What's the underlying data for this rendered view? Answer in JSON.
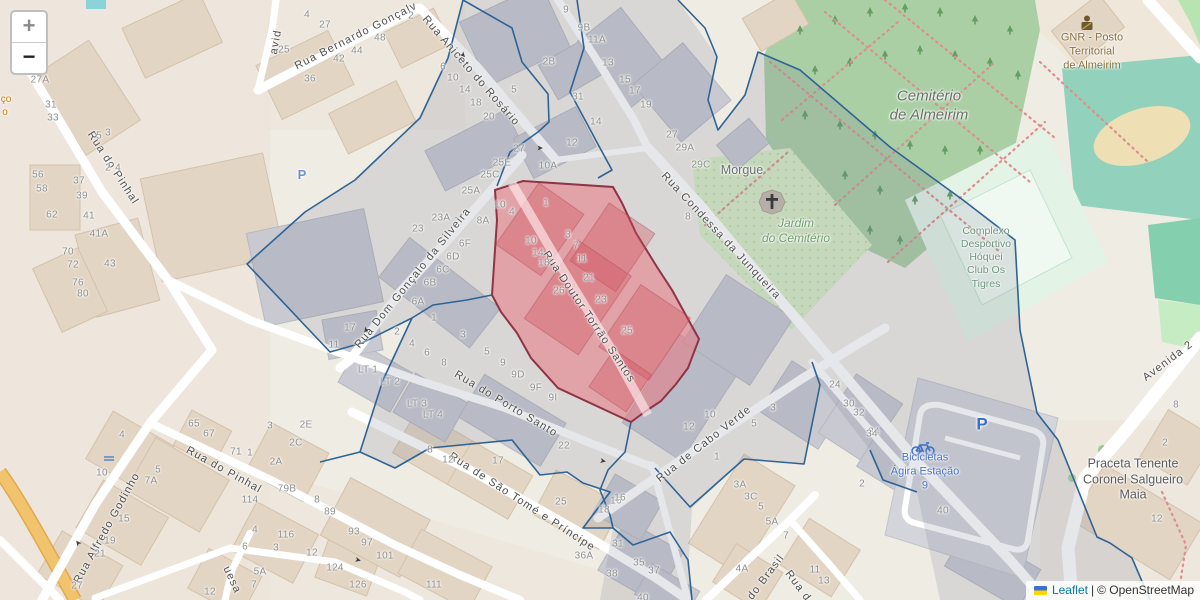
{
  "controls": {
    "zoom_in": "+",
    "zoom_out": "−"
  },
  "attribution": {
    "leaflet": "Leaflet",
    "separator": " | ",
    "osm": "© OpenStreetMap"
  },
  "colors": {
    "parcel_fill": "#e87f8a",
    "parcel_border": "#8f3346",
    "boundary_blue": "#2f6395",
    "cemetery_green": "#abcfa5",
    "jardim_green": "#d9edc6",
    "pitch_teal": "#92d1bc",
    "street_white": "#ffffff",
    "leaflet_link_blue": "#0078a8",
    "parking_blue": "#3a6cc8"
  },
  "streets": [
    [
      "Rua do Pinhal",
      113,
      168,
      57
    ],
    [
      "Rua do Pinhal",
      224,
      470,
      29
    ],
    [
      "Rua Alfredo Godinho",
      107,
      528,
      -61
    ],
    [
      "Rua Bernardo Gonçalv",
      356,
      36,
      -27
    ],
    [
      "avid",
      276,
      42,
      -80
    ],
    [
      "Rua Aniceto do Rosário",
      471,
      71,
      49
    ],
    [
      "Rua Dom Gonçalo da Silveira",
      413,
      278,
      -51
    ],
    [
      "Rua Doutor Torrão Santos",
      589,
      317,
      56
    ],
    [
      "Rua Condessa da Junqueira",
      721,
      236,
      47
    ],
    [
      "Rua do Porto Santo",
      506,
      404,
      31
    ],
    [
      "Rua de Cabo Verde",
      704,
      444,
      -38
    ],
    [
      "Rua de São Tomé e Príncipe",
      522,
      502,
      33
    ],
    [
      "do Brasil",
      766,
      577,
      -53
    ],
    [
      "Rua d",
      798,
      586,
      53
    ],
    [
      "Avenida 2",
      1168,
      361,
      -37
    ],
    [
      "uesa",
      232,
      580,
      65
    ]
  ],
  "pois": [
    {
      "lines": [
        "Morgue"
      ],
      "x": 742,
      "y": 171,
      "color": "#6d6d6d",
      "size": 12.5,
      "italic": false
    },
    {
      "lines": [
        "Cemitério",
        "de Almeirim"
      ],
      "x": 929,
      "y": 106,
      "color": "#687068",
      "size": 15,
      "italic": true
    },
    {
      "lines": [
        "Jardim",
        "do Cemitério"
      ],
      "x": 796,
      "y": 231,
      "color": "#72a072",
      "size": 12,
      "italic": true
    },
    {
      "lines": [
        "Complexo",
        "Desportivo",
        "Hóquei",
        "Club Os",
        "Tigres"
      ],
      "x": 986,
      "y": 258,
      "color": "#6e957e",
      "size": 10.5,
      "italic": false
    },
    {
      "lines": [
        "GNR - Posto",
        "Territorial",
        "de Almeirim"
      ],
      "x": 1092,
      "y": 52,
      "color": "#8a7240",
      "size": 11,
      "italic": false
    },
    {
      "lines": [
        "Bicicletas",
        "Ágira Estação",
        "9"
      ],
      "x": 925,
      "y": 472,
      "color": "#4a72c8",
      "size": 11,
      "italic": false
    },
    {
      "lines": [
        "Praceta Tenente",
        "Coronel Salgueiro",
        "Maia"
      ],
      "x": 1133,
      "y": 480,
      "color": "#5c5c5c",
      "size": 12.5,
      "italic": false
    },
    {
      "lines": [
        "ço"
      ],
      "x": 6,
      "y": 100,
      "color": "#d07b00",
      "size": 10,
      "italic": false
    },
    {
      "lines": [
        "o"
      ],
      "x": 5,
      "y": 113,
      "color": "#d07b00",
      "size": 10,
      "italic": false
    }
  ],
  "parking_labels": [
    {
      "t": "P",
      "x": 982,
      "y": 424,
      "size": 17,
      "color": "#3a6cc8"
    },
    {
      "t": "P",
      "x": 302,
      "y": 175,
      "size": 13,
      "color": "#6d92d4"
    }
  ],
  "arrows": [
    [
      463,
      55,
      47
    ],
    [
      540,
      148,
      0
    ],
    [
      366,
      330,
      125
    ],
    [
      78,
      543,
      233
    ],
    [
      358,
      560,
      15
    ],
    [
      603,
      461,
      10
    ]
  ],
  "house_numbers": [
    [
      "27A",
      40,
      80
    ],
    [
      "31",
      51,
      105
    ],
    [
      "33",
      53,
      118
    ],
    [
      "5",
      99,
      136
    ],
    [
      "3",
      108,
      133
    ],
    [
      "56",
      38,
      175
    ],
    [
      "58",
      42,
      189
    ],
    [
      "62",
      52,
      215
    ],
    [
      "37",
      79,
      181
    ],
    [
      "39",
      82,
      196
    ],
    [
      "41",
      89,
      216
    ],
    [
      "41A",
      99,
      234
    ],
    [
      "43",
      110,
      264
    ],
    [
      "70",
      68,
      252
    ],
    [
      "72",
      73,
      265
    ],
    [
      "76",
      78,
      283
    ],
    [
      "80",
      83,
      294
    ],
    [
      "2",
      108,
      168
    ],
    [
      "4",
      118,
      168
    ],
    [
      "4",
      307,
      15
    ],
    [
      "27",
      325,
      25
    ],
    [
      "25",
      284,
      50
    ],
    [
      "36",
      310,
      79
    ],
    [
      "42",
      339,
      59
    ],
    [
      "44",
      357,
      51
    ],
    [
      "48",
      380,
      38
    ],
    [
      "2",
      411,
      16
    ],
    [
      "6",
      443,
      67
    ],
    [
      "10",
      453,
      78
    ],
    [
      "14",
      465,
      90
    ],
    [
      "18",
      476,
      103
    ],
    [
      "20",
      489,
      117
    ],
    [
      "5",
      514,
      90
    ],
    [
      "9",
      566,
      10
    ],
    [
      "9B",
      584,
      28
    ],
    [
      "11A",
      597,
      40
    ],
    [
      "13",
      608,
      63
    ],
    [
      "15",
      625,
      80
    ],
    [
      "17",
      635,
      91
    ],
    [
      "19",
      646,
      105
    ],
    [
      "2B",
      549,
      62
    ],
    [
      "31",
      578,
      97
    ],
    [
      "27",
      519,
      149
    ],
    [
      "25E",
      502,
      163
    ],
    [
      "25C",
      490,
      175
    ],
    [
      "25A",
      471,
      191
    ],
    [
      "23A",
      441,
      218
    ],
    [
      "23",
      418,
      229
    ],
    [
      "10A",
      548,
      166
    ],
    [
      "12",
      572,
      143
    ],
    [
      "14",
      596,
      122
    ],
    [
      "8A",
      483,
      221
    ],
    [
      "10",
      500,
      205
    ],
    [
      "4",
      512,
      212
    ],
    [
      "1",
      546,
      203
    ],
    [
      "3",
      568,
      235
    ],
    [
      "7",
      576,
      246
    ],
    [
      "11",
      582,
      259
    ],
    [
      "21",
      589,
      278
    ],
    [
      "23",
      601,
      300
    ],
    [
      "25",
      627,
      331
    ],
    [
      "26",
      559,
      291
    ],
    [
      "10",
      531,
      241
    ],
    [
      "14",
      538,
      253
    ],
    [
      "18",
      544,
      263
    ],
    [
      "8",
      688,
      217
    ],
    [
      "5",
      487,
      352
    ],
    [
      "9",
      503,
      363
    ],
    [
      "9D",
      518,
      375
    ],
    [
      "9F",
      536,
      388
    ],
    [
      "9I",
      553,
      398
    ],
    [
      "6F",
      465,
      244
    ],
    [
      "6D",
      453,
      257
    ],
    [
      "6C",
      443,
      270
    ],
    [
      "6B",
      430,
      283
    ],
    [
      "6A",
      418,
      302
    ],
    [
      "1",
      434,
      318
    ],
    [
      "17",
      350,
      328
    ],
    [
      "11",
      334,
      345
    ],
    [
      "2",
      397,
      332
    ],
    [
      "3",
      463,
      335
    ],
    [
      "4",
      412,
      344
    ],
    [
      "6",
      427,
      353
    ],
    [
      "8",
      444,
      363
    ],
    [
      "LT 1",
      368,
      370
    ],
    [
      "LT 2",
      390,
      382
    ],
    [
      "LT 3",
      417,
      404
    ],
    [
      "LT 4",
      433,
      415
    ],
    [
      "27",
      672,
      135
    ],
    [
      "29A",
      685,
      148
    ],
    [
      "29C",
      701,
      165
    ],
    [
      "4",
      122,
      435
    ],
    [
      "10",
      102,
      473
    ],
    [
      "5",
      158,
      470
    ],
    [
      "7A",
      151,
      481
    ],
    [
      "15",
      124,
      519
    ],
    [
      "19",
      110,
      541
    ],
    [
      "21",
      100,
      554
    ],
    [
      "27",
      77,
      586
    ],
    [
      "65",
      194,
      424
    ],
    [
      "67",
      209,
      434
    ],
    [
      "71",
      236,
      452
    ],
    [
      "1",
      250,
      453
    ],
    [
      "3",
      270,
      426
    ],
    [
      "2E",
      306,
      425
    ],
    [
      "2C",
      296,
      443
    ],
    [
      "2A",
      276,
      462
    ],
    [
      "79B",
      287,
      489
    ],
    [
      "114",
      250,
      500
    ],
    [
      "8",
      317,
      500
    ],
    [
      "4",
      255,
      530
    ],
    [
      "6",
      245,
      547
    ],
    [
      "116",
      286,
      535
    ],
    [
      "3",
      276,
      548
    ],
    [
      "12",
      312,
      553
    ],
    [
      "5A",
      260,
      572
    ],
    [
      "7",
      254,
      585
    ],
    [
      "12",
      210,
      592
    ],
    [
      "8",
      430,
      450
    ],
    [
      "12",
      448,
      460
    ],
    [
      "17",
      498,
      461
    ],
    [
      "22",
      564,
      446
    ],
    [
      "25",
      561,
      502
    ],
    [
      "18",
      604,
      510
    ],
    [
      "16",
      616,
      501
    ],
    [
      "36A",
      584,
      556
    ],
    [
      "38",
      612,
      574
    ],
    [
      "89",
      330,
      512
    ],
    [
      "93",
      354,
      532
    ],
    [
      "97",
      367,
      543
    ],
    [
      "101",
      385,
      556
    ],
    [
      "111",
      434,
      585
    ],
    [
      "124",
      335,
      568
    ],
    [
      "126",
      358,
      585
    ],
    [
      "10",
      710,
      415
    ],
    [
      "12",
      689,
      427
    ],
    [
      "3",
      773,
      408
    ],
    [
      "5",
      754,
      424
    ],
    [
      "1",
      717,
      457
    ],
    [
      "24",
      835,
      385
    ],
    [
      "30",
      849,
      404
    ],
    [
      "32",
      859,
      413
    ],
    [
      "34",
      874,
      432
    ],
    [
      "3A",
      740,
      485
    ],
    [
      "3C",
      751,
      497
    ],
    [
      "5",
      761,
      507
    ],
    [
      "5A",
      772,
      522
    ],
    [
      "7",
      786,
      536
    ],
    [
      "2",
      862,
      484
    ],
    [
      "16",
      620,
      498
    ],
    [
      "31",
      618,
      544
    ],
    [
      "35",
      639,
      563
    ],
    [
      "37",
      654,
      571
    ],
    [
      "4A",
      742,
      569
    ],
    [
      "11",
      815,
      570
    ],
    [
      "13",
      824,
      581
    ],
    [
      "40",
      643,
      598
    ],
    [
      "40",
      943,
      511
    ],
    [
      "34",
      872,
      434
    ],
    [
      "2",
      1165,
      443
    ],
    [
      "12",
      1157,
      519
    ],
    [
      "8",
      1176,
      405
    ]
  ]
}
